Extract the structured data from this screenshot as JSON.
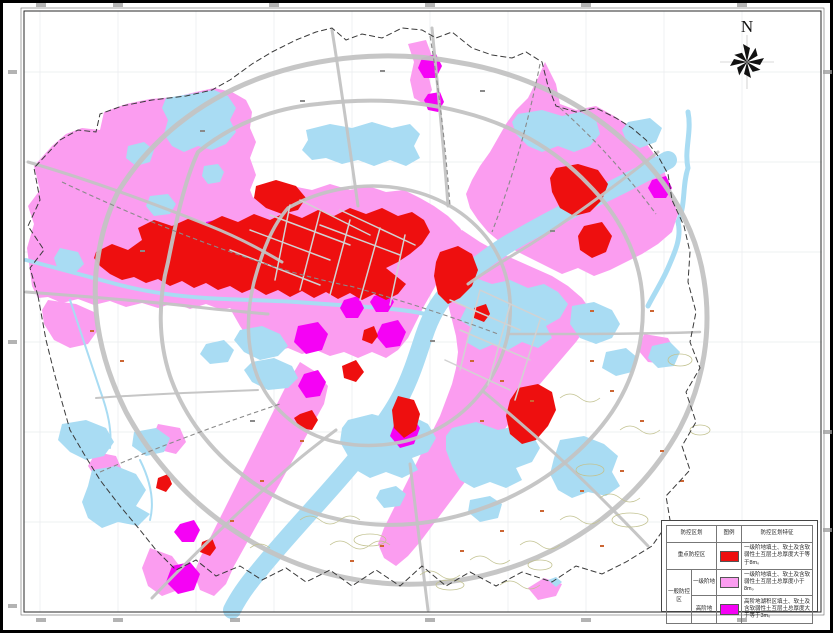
{
  "map": {
    "north_label": "N"
  },
  "colors": {
    "red": "#ee0f0f",
    "pink": "#fb9df0",
    "magenta": "#f502f5",
    "water": "#a9dcf3",
    "road": "#c3c3c3",
    "boundary": "#3a3a3a",
    "contour": "#c2c290",
    "grid": "#e8ebee"
  },
  "legend": {
    "headers": {
      "zone": "防控区划",
      "symbol": "图例",
      "feature": "防控区划特征"
    },
    "rows": [
      {
        "zone": "重点防控区",
        "color_key": "red",
        "desc": "一级阶地填土、软土及含软弱性土互层土总厚度大于等于8m。"
      },
      {
        "group": "一般防控区",
        "zone": "一级阶地",
        "color_key": "pink",
        "desc": "一级阶地填土、软土及含软弱性土互层土总厚度小于8m。"
      },
      {
        "zone": "高阶地",
        "color_key": "magenta",
        "desc": "高阶地湖积区填土、软土及含软弱性土互层土总厚度大于等于3m。"
      }
    ]
  }
}
